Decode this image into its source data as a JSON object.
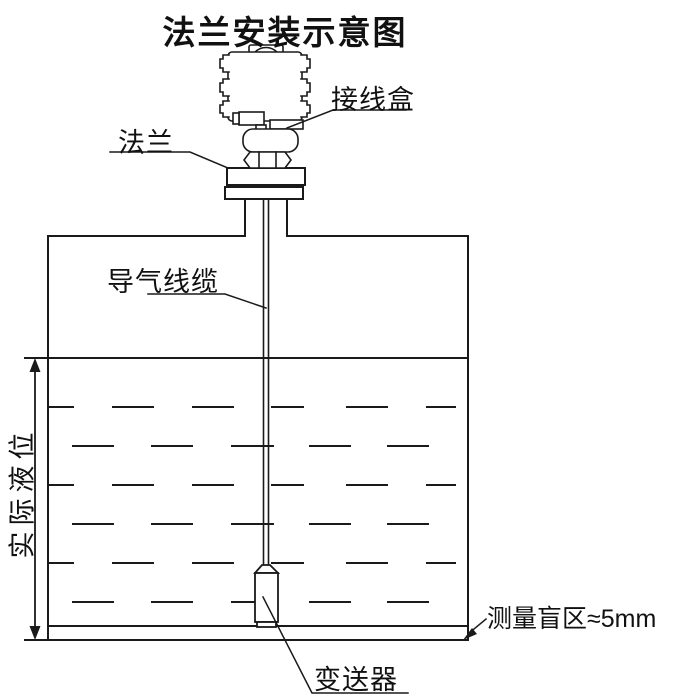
{
  "title": "法兰安装示意图",
  "labels": {
    "junction_box": "接线盒",
    "flange": "法兰",
    "air_cable": "导气线缆",
    "actual_level": "实际液位",
    "transmitter": "变送器",
    "blind_zone": "测量盲区≈5mm"
  },
  "colors": {
    "line": "#1a1a1a",
    "background": "#ffffff"
  }
}
